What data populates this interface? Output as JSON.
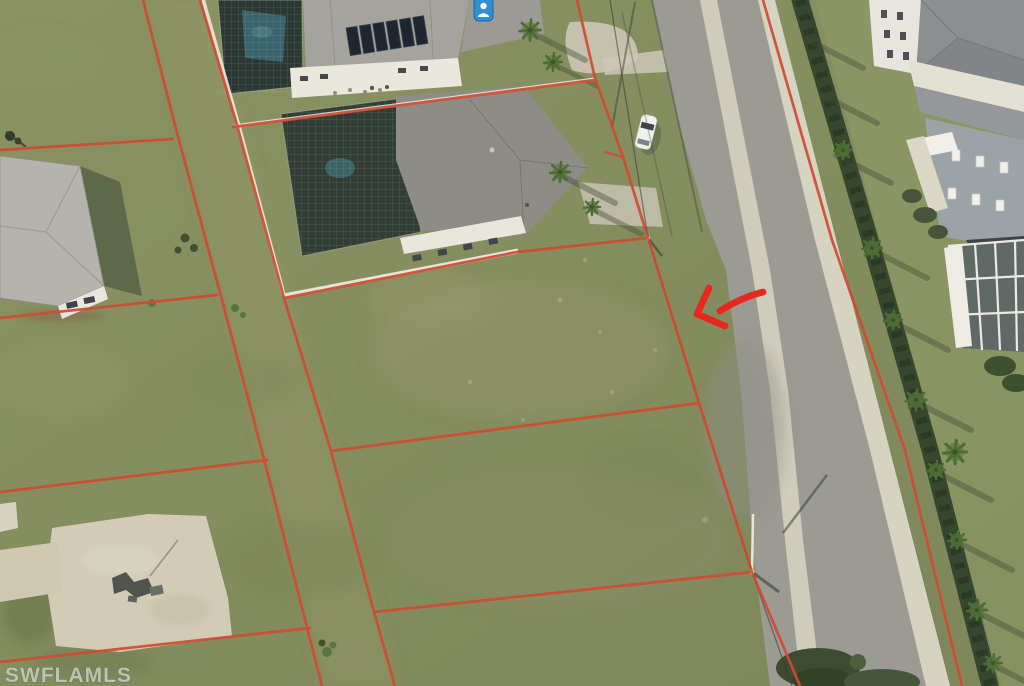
{
  "watermark": {
    "text": "SWFLAMLS"
  },
  "overlay": {
    "arrow_direction": "pointing-left-at-subject-lot",
    "poi_icon": "blue-map-marker",
    "line_meaning": "red-parcel-boundaries"
  },
  "colors": {
    "parcel_line": "#d14a32",
    "arrow": "#e8281e",
    "watermark": "#ccd1c5",
    "poi": "#2f8fd2",
    "road": "#9b9b93",
    "road_stripe": "#d9d5c2",
    "grass": "#87905f",
    "sand_pad": "#d2ccb6",
    "fence": "#ece9df",
    "hedge": "#37462e",
    "pool_water": "#3a646d"
  }
}
